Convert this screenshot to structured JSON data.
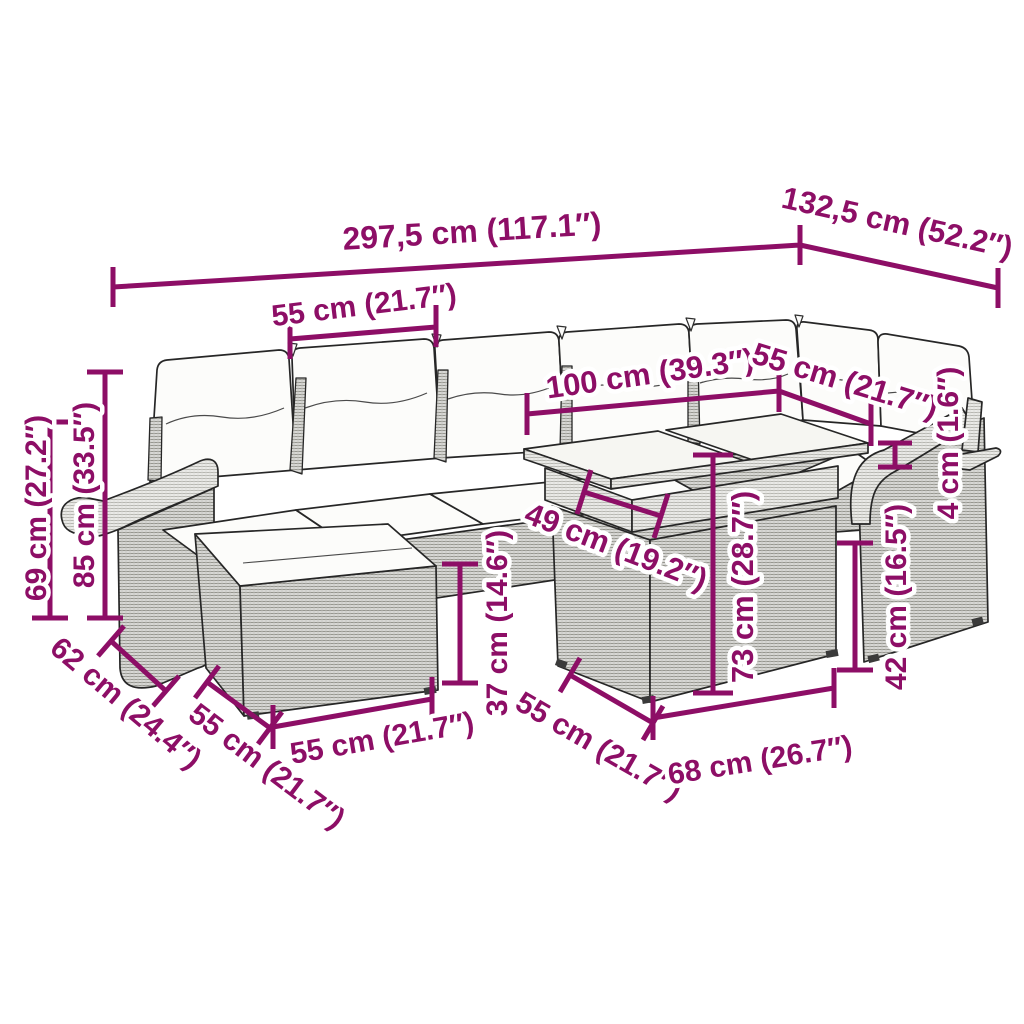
{
  "colors": {
    "dimension": "#8d0e66",
    "outline": "#262626",
    "cushion": "#fcfcfa",
    "rattan_dark": "#d8d8d5",
    "rattan_light": "#eaeae7",
    "background": "#ffffff"
  },
  "dims": {
    "total_width": "297,5 cm (117.1″)",
    "total_depth": "132,5 cm (52.2″)",
    "module_width": "55 cm (21.7″)",
    "table_length": "100 cm (39.3″)",
    "corner_module_width": "55 cm (21.7″)",
    "armrest_cap_thickness": "4 cm (1.6″)",
    "backrest_height": "69 cm (27.2″)",
    "total_height": "85 cm (33.5″)",
    "under_table_clearance": "49 cm (19.2″)",
    "table_height": "73 cm (28.7″)",
    "ottoman_height": "37 cm (14.6″)",
    "ottoman_depth": "62 cm (24.4″)",
    "ottoman_side_width": "55 cm (21.7″)",
    "ottoman_front_width": "55 cm (21.7″)",
    "seat_module_depth": "55 cm (21.7″)",
    "table_base_width": "68 cm (26.7″)",
    "seat_height": "42 cm (16.5″)"
  }
}
